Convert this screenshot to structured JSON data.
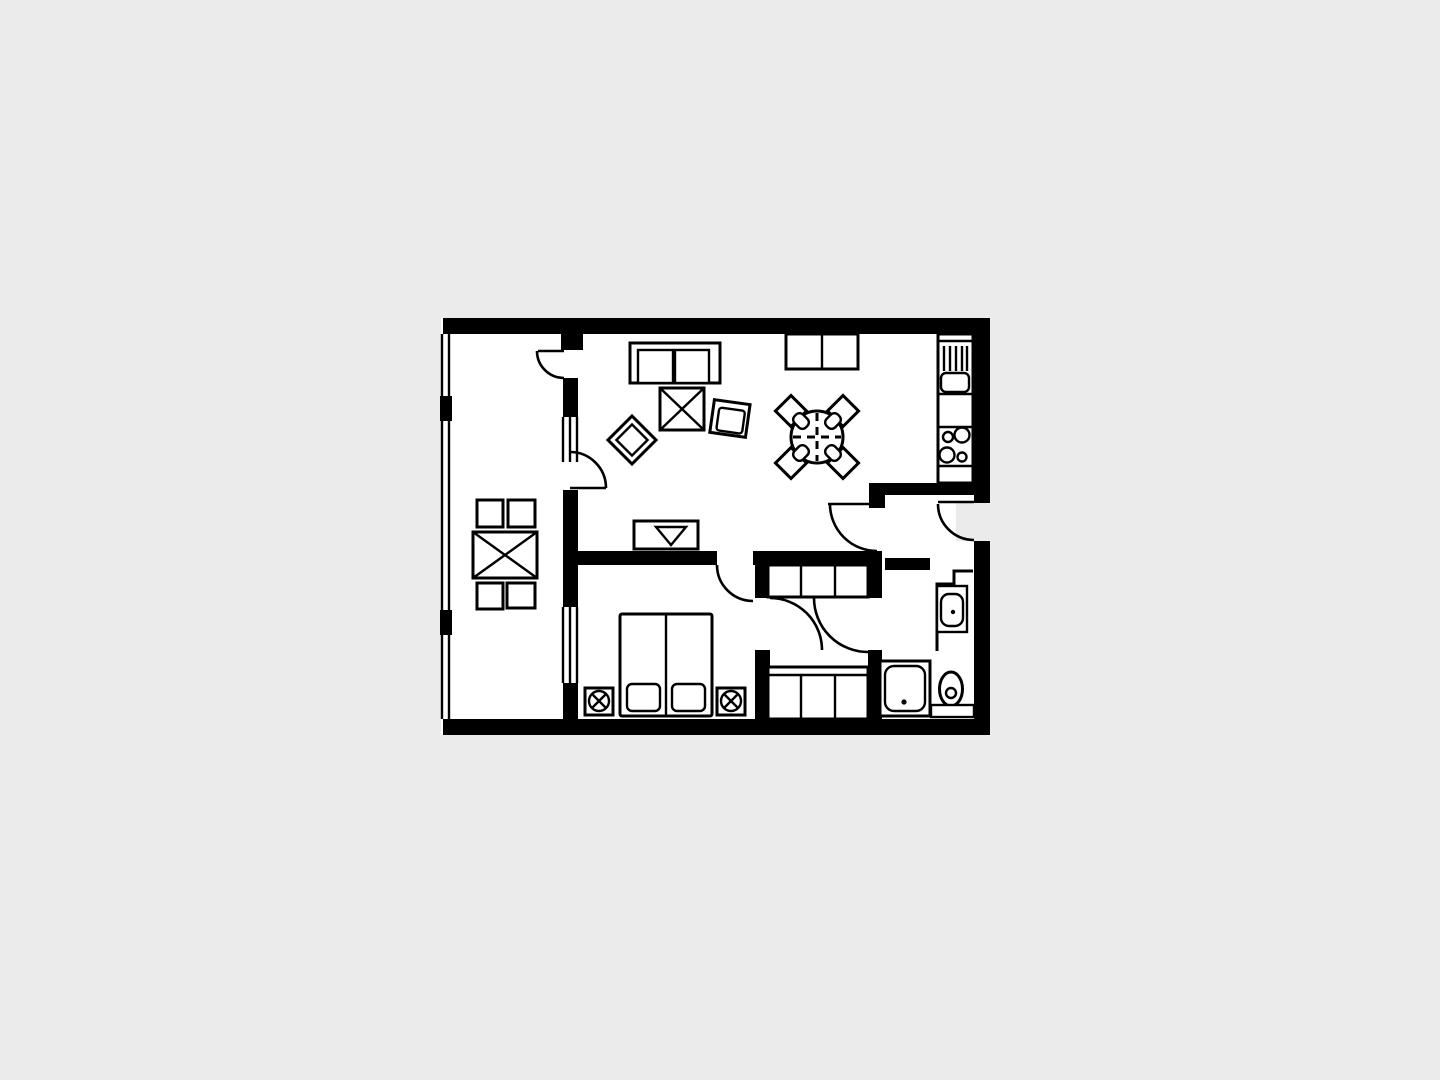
{
  "image": {
    "kind": "apartment floor plan",
    "style": "black line art on white floor, light gray page background",
    "text_labels": "none visible"
  },
  "colors": {
    "background": "#ebebeb",
    "floor": "#ffffff",
    "walls": "#000000"
  },
  "rooms": [
    {
      "id": "balcony",
      "label": "Balcony",
      "items": [
        "square table",
        "4 stools",
        "railing with 2 posts"
      ]
    },
    {
      "id": "living-room",
      "label": "Living room",
      "items": [
        "two-seat sofa",
        "coffee table",
        "2 armchairs",
        "tv",
        "sideboard"
      ]
    },
    {
      "id": "dining-area",
      "label": "Dining area",
      "items": [
        "round table",
        "4 chairs"
      ]
    },
    {
      "id": "kitchenette",
      "label": "Kitchenette",
      "items": [
        "counter",
        "sink with drainer",
        "stove with 4 burners"
      ]
    },
    {
      "id": "entry-hall",
      "label": "Entry hall",
      "items": [
        "entrance door"
      ]
    },
    {
      "id": "bedroom",
      "label": "Bedroom",
      "items": [
        "double bed",
        "2 pillows",
        "2 nightstands with lamps",
        "window to balcony"
      ]
    },
    {
      "id": "closet-corridor",
      "label": "Closet corridor",
      "items": [
        "3-section wardrobe top",
        "3-section wardrobe bottom"
      ]
    },
    {
      "id": "bathroom",
      "label": "Bathroom",
      "items": [
        "shower tray",
        "washbasin",
        "toilet"
      ]
    }
  ],
  "openings": {
    "interior_doors": 6,
    "entrance_doors": 1,
    "windows": 2,
    "balcony_doors": 2
  }
}
